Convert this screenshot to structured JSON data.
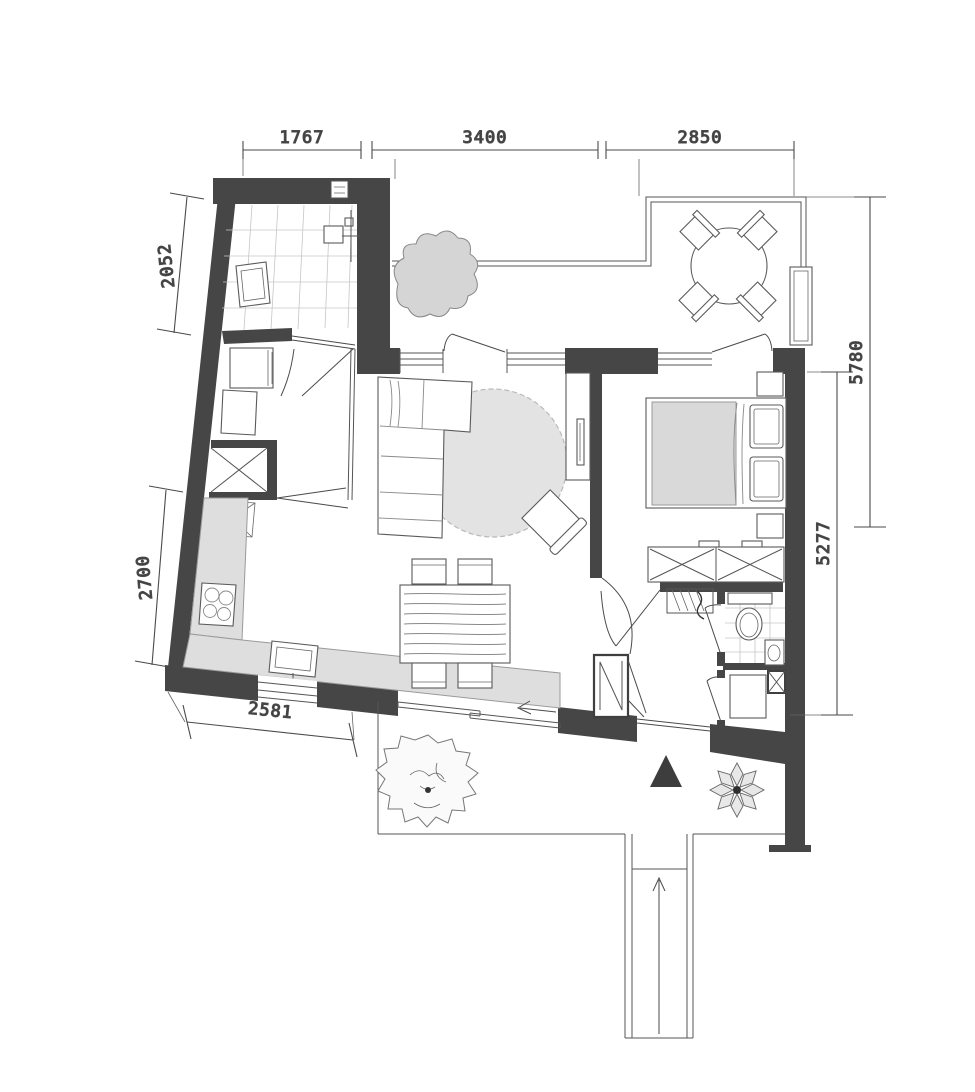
{
  "floor_plan": {
    "type": "apartment-floor-plan",
    "dims": {
      "top": [
        "1767",
        "3400",
        "2850"
      ],
      "left": [
        "2052",
        "2700"
      ],
      "right": [
        "5780",
        "5277"
      ],
      "bottom": [
        "2581"
      ]
    },
    "colors": {
      "wall": "#464646",
      "counter": "#dedede",
      "rug": "#e3e3e3",
      "duvet": "#d9d9d9",
      "shrub": "#d5d5d5",
      "entrance_marker": "#3d3d3d",
      "paper": "#ffffff"
    }
  }
}
